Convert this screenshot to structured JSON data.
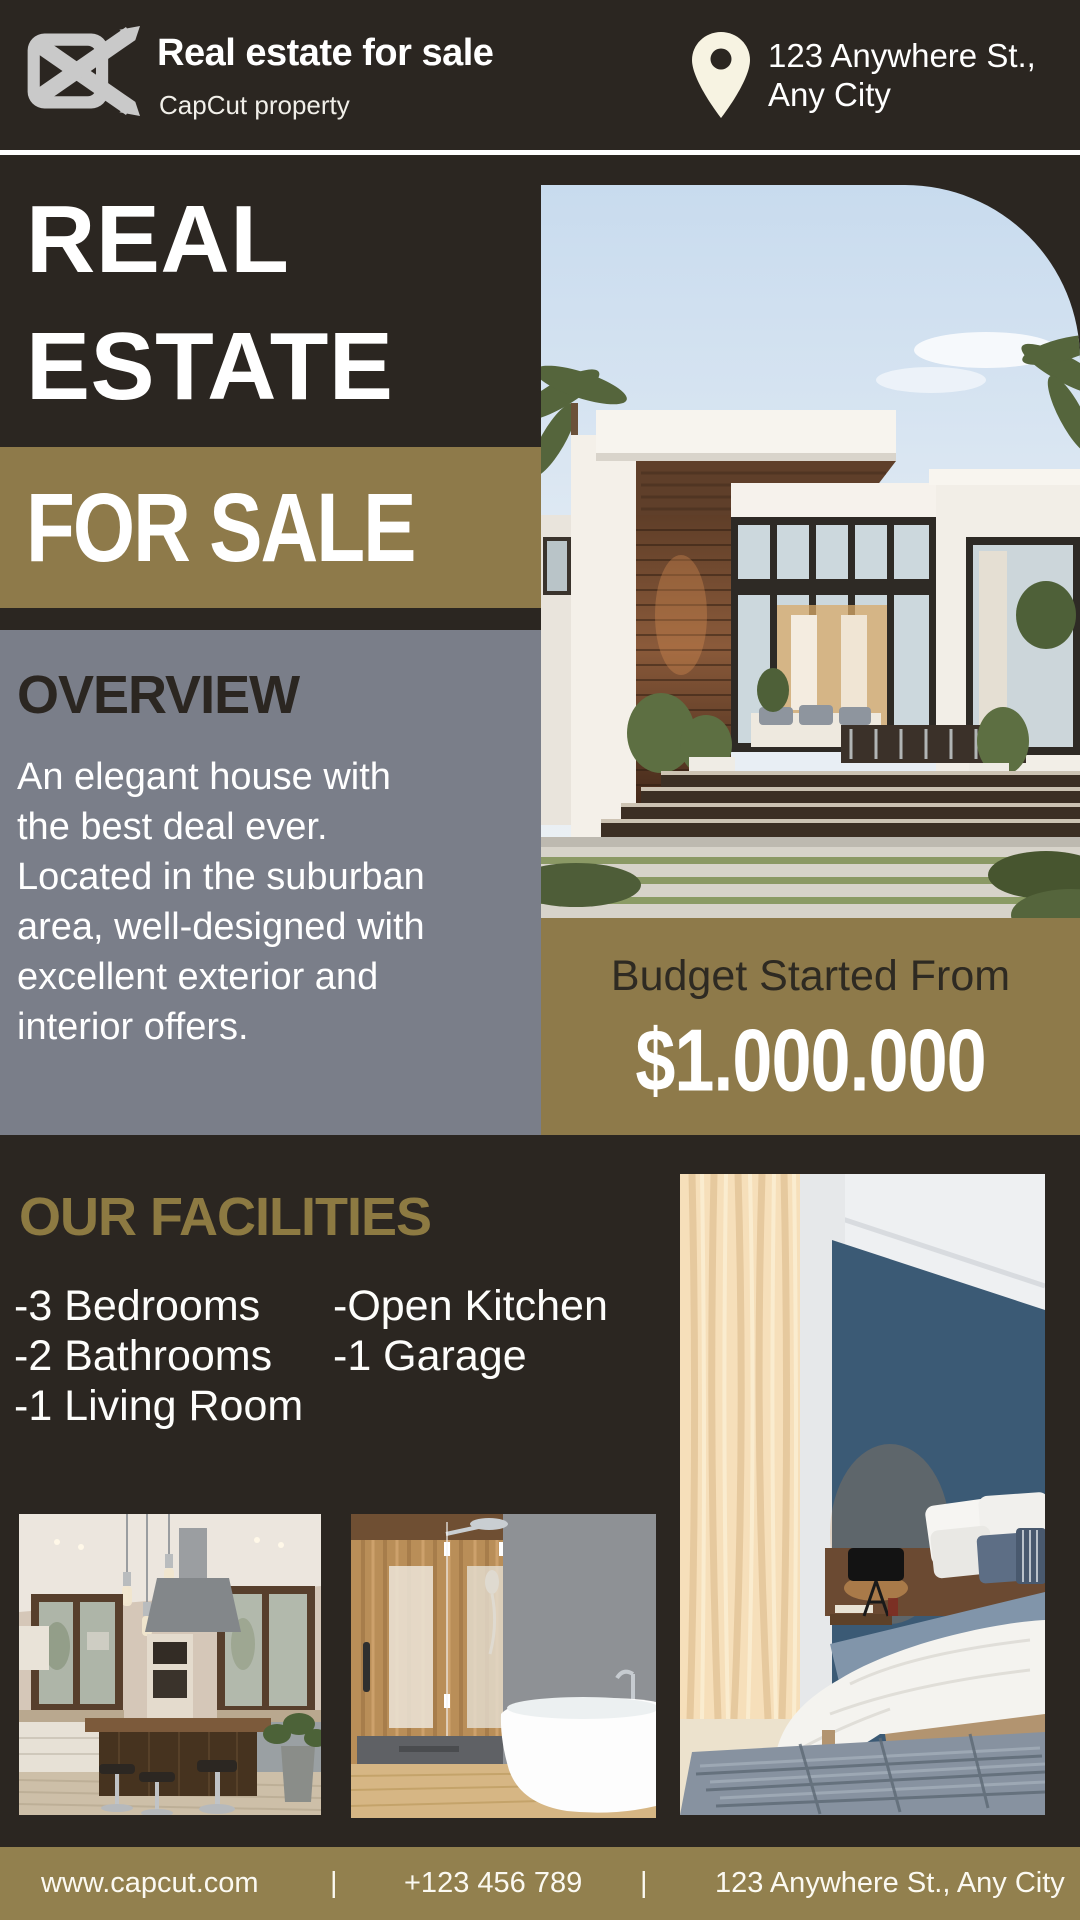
{
  "colors": {
    "background": "#2b2621",
    "gold": "#8e7a4a",
    "footer_gold": "#92804e",
    "panel_gray": "#7a7e89",
    "heading_gold": "#8d7a42",
    "dark_text": "#2b2621",
    "white": "#ffffff",
    "pin_cream": "#f7f3e2",
    "logo_gray": "#c9c9c9"
  },
  "header": {
    "brand_title": "Real estate for sale",
    "brand_subtitle": "CapCut property",
    "address_line1": "123 Anywhere St.,",
    "address_line2": "Any City"
  },
  "hero": {
    "title_line1": "REAL",
    "title_line2": "ESTATE",
    "banner_label": "FOR SALE"
  },
  "overview": {
    "heading": "OVERVIEW",
    "lines": [
      "An elegant house with",
      "the best deal ever.",
      "Located in the suburban",
      "area, well-designed with",
      "excellent exterior and",
      "interior offers."
    ]
  },
  "budget": {
    "label": "Budget Started From",
    "price": "$1.000.000"
  },
  "facilities": {
    "heading": "OUR FACILITIES",
    "column1": [
      "-3 Bedrooms",
      "-2 Bathrooms",
      "-1 Living Room"
    ],
    "column2": [
      "-Open Kitchen",
      "-1 Garage"
    ]
  },
  "photos": {
    "hero_photo": "modern-house-exterior",
    "kitchen_photo": "kitchen-interior",
    "bathroom_photo": "bathroom-interior",
    "bedroom_photo": "bedroom-interior"
  },
  "footer": {
    "website": "www.capcut.com",
    "separator": "|",
    "phone": "+123 456 789",
    "address": "123 Anywhere St., Any City"
  }
}
